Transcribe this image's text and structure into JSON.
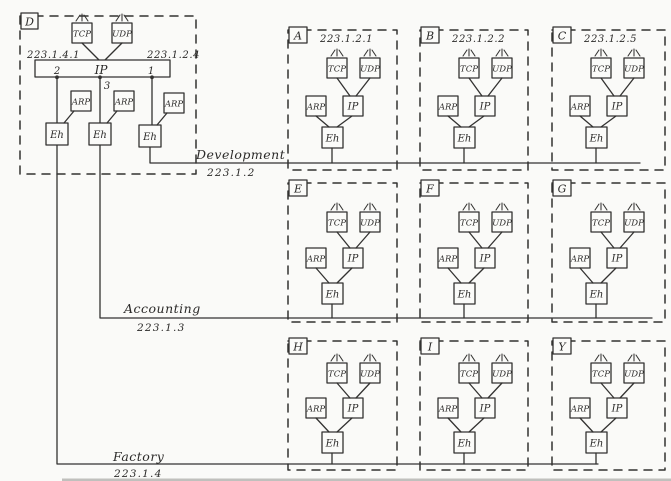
{
  "router": {
    "letter": "D",
    "left_address": "223.1.4.1",
    "right_address": "223.1.2.4",
    "ip_label": "IP",
    "port_left": "2",
    "port_right": "1",
    "port_bottom": "3",
    "tcp": "TCP",
    "udp": "UDP",
    "arp": "ARP",
    "eh": "Eh"
  },
  "hosts": [
    {
      "letter": "A",
      "address": "223.1.2.1"
    },
    {
      "letter": "B",
      "address": "223.1.2.2"
    },
    {
      "letter": "C",
      "address": "223.1.2.5"
    },
    {
      "letter": "E",
      "address": ""
    },
    {
      "letter": "F",
      "address": ""
    },
    {
      "letter": "G",
      "address": ""
    },
    {
      "letter": "H",
      "address": ""
    },
    {
      "letter": "I",
      "address": ""
    },
    {
      "letter": "Y",
      "address": ""
    }
  ],
  "host_components": {
    "tcp": "TCP",
    "udp": "UDP",
    "arp": "ARP",
    "ip": "IP",
    "eh": "Eh"
  },
  "networks": [
    {
      "name": "Development",
      "address": "223.1.2"
    },
    {
      "name": "Accounting",
      "address": "223.1.3"
    },
    {
      "name": "Factory",
      "address": "223.1.4"
    }
  ],
  "colors": {
    "ink": "#333231",
    "paper": "#fafaf8"
  }
}
